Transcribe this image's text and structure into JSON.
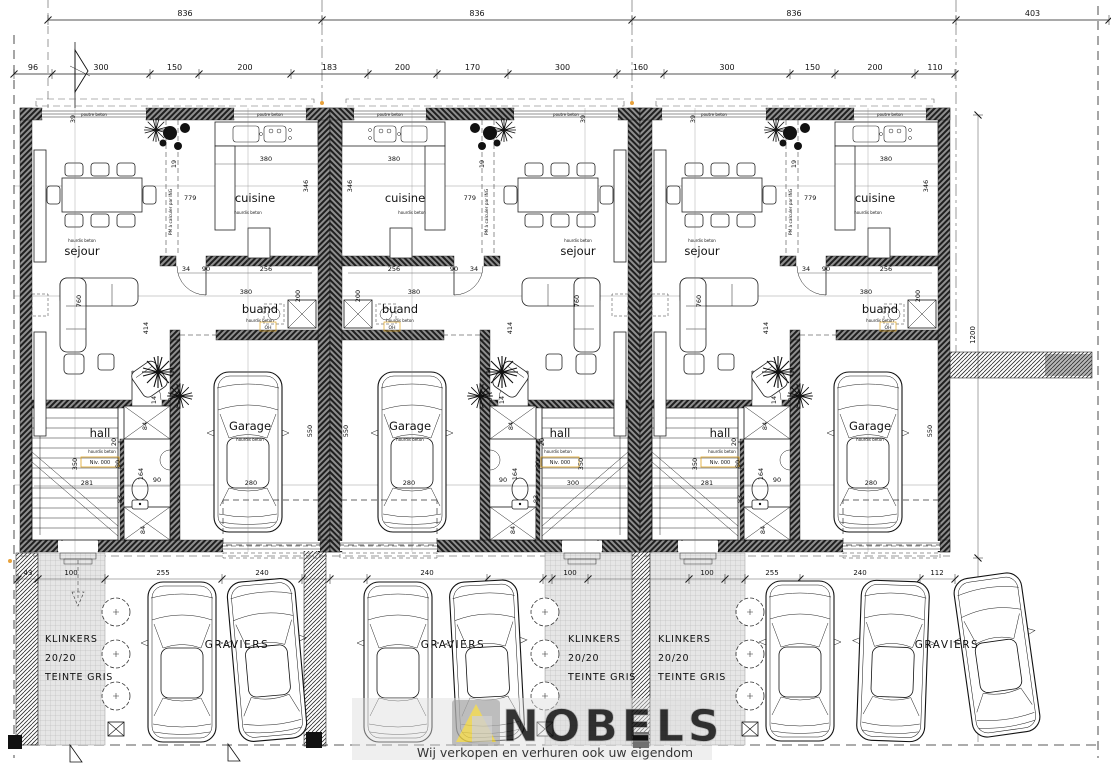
{
  "drawing": {
    "top_dims_row1": [
      "836",
      "836",
      "836",
      "403"
    ],
    "top_dims_row2": [
      "96",
      "300",
      "150",
      "200",
      "183",
      "200",
      "170",
      "300",
      "160",
      "300",
      "150",
      "200",
      "110"
    ],
    "rooms": {
      "sejour": "sejour",
      "cuisine": "cuisine",
      "buanderie": "buand",
      "garage": "Garage",
      "hall": "hall"
    },
    "annotations": {
      "poutre_beton": "poutre beton",
      "hourdis_beton": "hourdis beton",
      "pm_ing": "PM à calculer par ING",
      "niveau": "Niv. 000",
      "oh": "OH"
    },
    "dims": {
      "cuisine_width": "380",
      "cuisine_depth": "346",
      "beam_length": "779",
      "wall_gap": "19",
      "buand_d34": "34",
      "buand_door": "90",
      "buand_d256": "256",
      "buand_width": "380",
      "buand_depth": "200",
      "garage_depth": "550",
      "garage_door": "280",
      "sejour_depth": "760",
      "sejour_wall": "39",
      "sejour_d414": "414",
      "hall_d14": "14",
      "stairs_d350": "350",
      "wc_d164": "164",
      "wc_d80": "80",
      "wc_d83": "83",
      "wc_d84": "84",
      "wc_d90": "90",
      "wc_d20": "20",
      "right_height": "1200",
      "car_space_len": "496"
    },
    "units": [
      {
        "id": "house-1",
        "hall_dim": "281"
      },
      {
        "id": "house-2",
        "hall_dim": "300"
      },
      {
        "id": "house-3",
        "hall_dim": "281"
      }
    ],
    "outdoor": {
      "klinkers_l1": "KLINKERS",
      "klinkers_l2": "20/20",
      "klinkers_l3": "TEINTE GRIS",
      "graviers": "GRAVIERS",
      "dims_left": [
        "43",
        "100",
        "255",
        "240"
      ],
      "dims_mid": [
        "240",
        "100",
        "100"
      ],
      "dims_right": [
        "255",
        "240",
        "112"
      ]
    },
    "watermark": {
      "brand": "NOBELS",
      "tagline": "Wij verkopen en verhuren ook uw eigendom"
    },
    "colors": {
      "accent_orange": "#d98e04",
      "watermark_yellow": "#e6cd4e",
      "paving_gray": "#e4e4e4"
    }
  }
}
